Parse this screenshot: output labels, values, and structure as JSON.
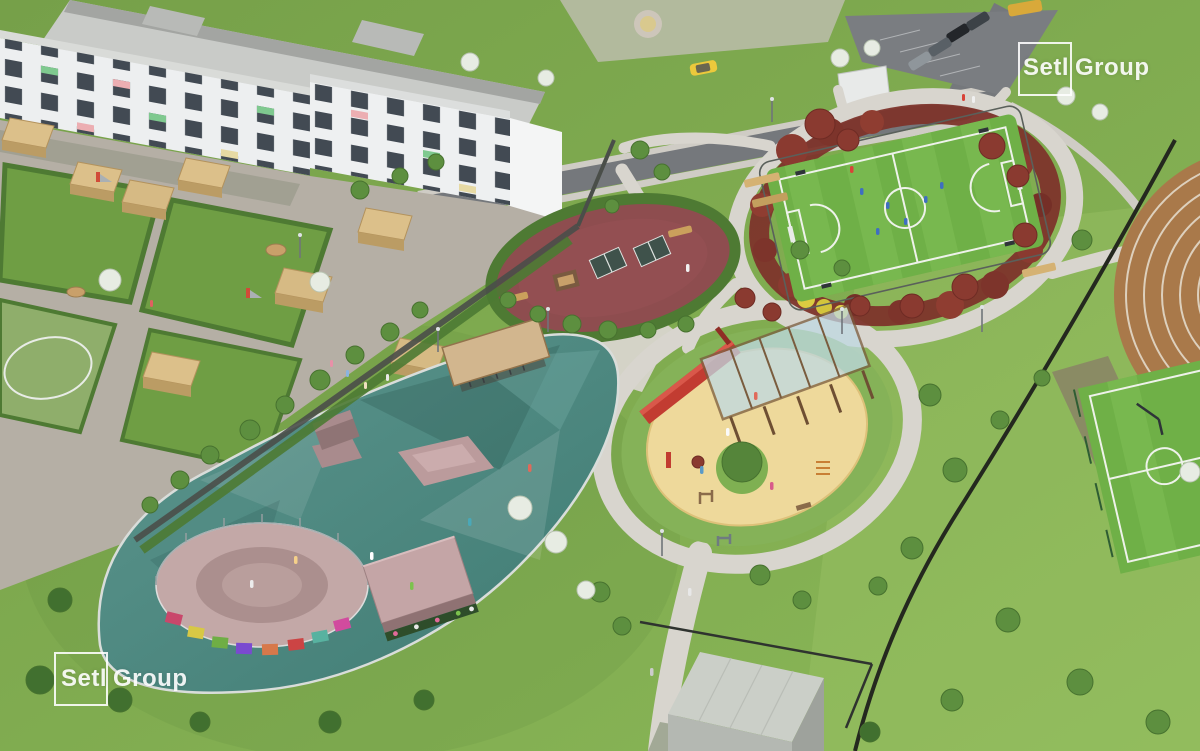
{
  "meta": {
    "kind": "aerial-architectural-render",
    "width": 1200,
    "height": 751
  },
  "brand": {
    "name": "SetlGroup",
    "wordmark_part1": "Setl",
    "wordmark_part2": "Group",
    "wordmark_color": "#ffffff"
  },
  "watermarks": [
    {
      "id": "logo-top-right",
      "position": "top-right"
    },
    {
      "id": "logo-bottom-left",
      "position": "bottom-left"
    }
  ],
  "scene": {
    "areas": [
      "kindergarten-building",
      "kindergarten-yard",
      "apartment-building-top",
      "apartment-building-right",
      "parking-lot",
      "roads",
      "park-paths",
      "table-tennis-area",
      "sports-court",
      "shrub-ring",
      "workout-playground",
      "pergola",
      "skatepark",
      "pump-track-bowl",
      "bike-shelter",
      "running-track",
      "second-court",
      "utility-building",
      "fences",
      "trees",
      "people",
      "light-poles"
    ],
    "palette": {
      "grass": "#7aa24b",
      "grass_light": "#96c063",
      "paving": "#d8d5ce",
      "asphalt": "#75787c",
      "gravel": "#b5afa5",
      "building_white": "#edeff0",
      "roof_grey": "#c9cbc8",
      "wood": "#dcc08a",
      "wood_dark": "#b3925c",
      "hedge": "#4e7a33",
      "shrub_red": "#7d342b",
      "bush_yellow": "#dbcc41",
      "court_green": "#6fb047",
      "line_white": "#eef2ea",
      "sand": "#eed99b",
      "rubber_maroon": "#8e4d4f",
      "skate_teal": "#4f8c85",
      "ramp_mauve": "#c4a5a6",
      "red_accent": "#c23c31",
      "track_brown": "#a9794a",
      "fence_dark": "#3c403c"
    }
  }
}
